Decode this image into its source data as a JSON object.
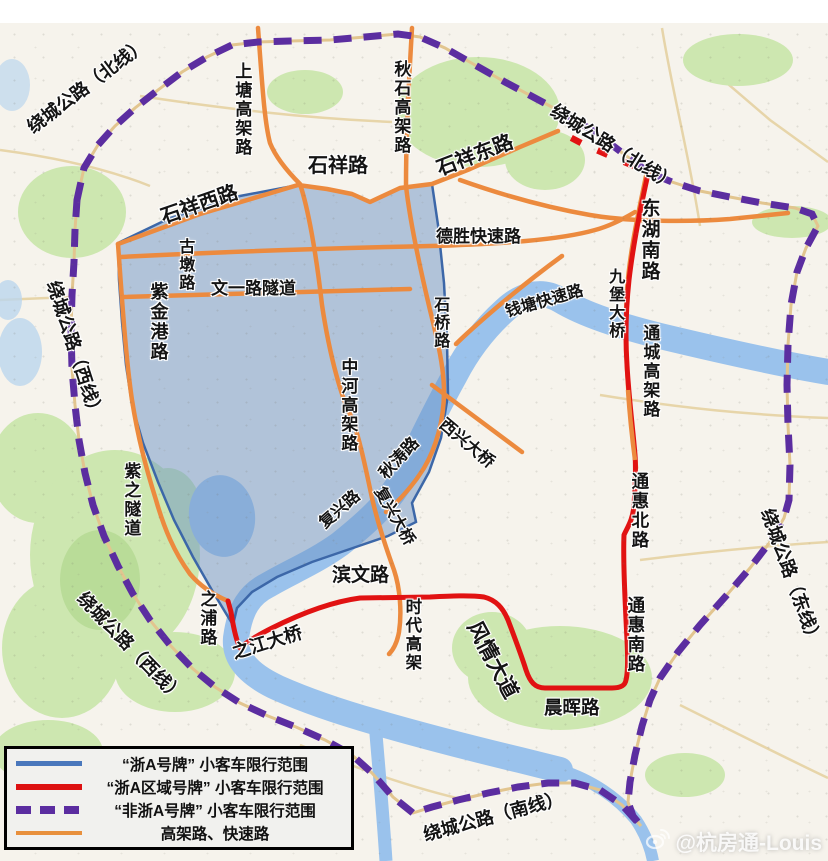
{
  "colors": {
    "zone_blue_fill": "#6c94c6",
    "zone_blue_border": "#3c67a8",
    "regional_red": "#e11212",
    "ring_purple": "#5b2da0",
    "elevated_orange": "#ec8a3e",
    "water": "#9ac2ec",
    "green": "#cde7b0"
  },
  "road_labels": [
    {
      "id": "raocheng-north-west",
      "text": "绕城公路（北线）"
    },
    {
      "id": "raocheng-north-east",
      "text": "绕城公路（北线）"
    },
    {
      "id": "raocheng-west-upper",
      "text": "绕城公路（西线）"
    },
    {
      "id": "raocheng-west-lower",
      "text": "绕城公路（西线）"
    },
    {
      "id": "raocheng-east",
      "text": "绕城公路（东线）"
    },
    {
      "id": "raocheng-south",
      "text": "绕城公路（南线）"
    },
    {
      "id": "shixiang-west",
      "text": "石祥西路"
    },
    {
      "id": "shixiang",
      "text": "石祥路"
    },
    {
      "id": "shixiang-east",
      "text": "石祥东路"
    },
    {
      "id": "desheng",
      "text": "德胜快速路"
    },
    {
      "id": "donghu-south",
      "text": "东湖南路"
    },
    {
      "id": "shangtang",
      "text": "上塘高架路"
    },
    {
      "id": "qiushi",
      "text": "秋石高架路"
    },
    {
      "id": "gudun",
      "text": "古墩路"
    },
    {
      "id": "wenyi-tunnel",
      "text": "文一路隧道"
    },
    {
      "id": "zijingang",
      "text": "紫金港路"
    },
    {
      "id": "qiantang-express",
      "text": "钱塘快速路"
    },
    {
      "id": "jiubao-bridge",
      "text": "九堡大桥"
    },
    {
      "id": "shiqiao",
      "text": "石桥路"
    },
    {
      "id": "zhonghe-viaduct",
      "text": "中河高架路"
    },
    {
      "id": "tongcheng-viaduct",
      "text": "通城高架路"
    },
    {
      "id": "xixing-bridge",
      "text": "西兴大桥"
    },
    {
      "id": "qiutao",
      "text": "秋涛路"
    },
    {
      "id": "fuxing-road",
      "text": "复兴路"
    },
    {
      "id": "fuxing-bridge",
      "text": "复兴大桥"
    },
    {
      "id": "binwen",
      "text": "滨文路"
    },
    {
      "id": "shidai-viaduct",
      "text": "时代高架"
    },
    {
      "id": "fengqing-avenue",
      "text": "风情大道"
    },
    {
      "id": "chenhui",
      "text": "晨晖路"
    },
    {
      "id": "tonghui-north",
      "text": "通惠北路"
    },
    {
      "id": "tonghui-south",
      "text": "通惠南路"
    },
    {
      "id": "zhipu",
      "text": "之浦路"
    },
    {
      "id": "zhijiang-bridge",
      "text": "之江大桥"
    },
    {
      "id": "zizhi-tunnel",
      "text": "紫之隧道"
    }
  ],
  "legend": {
    "items": [
      {
        "swatch": "blue-solid-line",
        "label": "“浙A号牌” 小客车限行范围"
      },
      {
        "swatch": "red-solid-line",
        "label": "“浙A区域号牌” 小客车限行范围"
      },
      {
        "swatch": "purple-dashed-line",
        "label": "“非浙A号牌” 小客车限行范围"
      },
      {
        "swatch": "orange-solid-line",
        "label": "高架路、快速路"
      }
    ]
  },
  "watermark": {
    "icon": "weibo-icon",
    "text": "@杭房通-Louis"
  }
}
